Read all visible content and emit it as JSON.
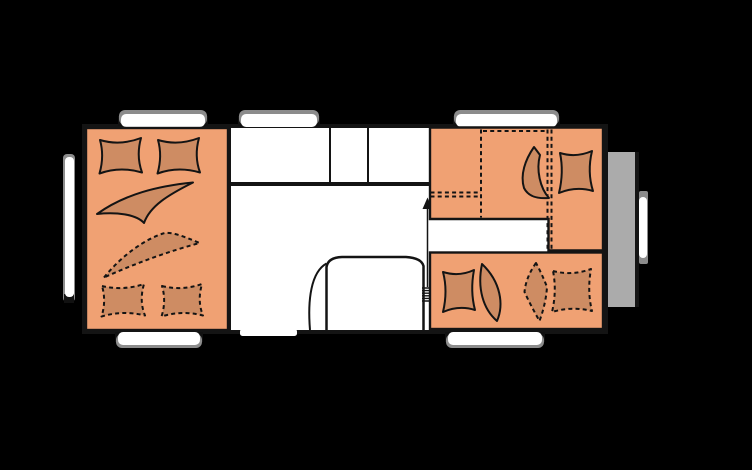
{
  "colors": {
    "background": "#000000",
    "floor": "#ffffff",
    "bed_area": "#f0a173",
    "bedding": "#ce8c63",
    "outline": "#141414",
    "front_storage": "#ababab",
    "window_frame": "#8c8c8c",
    "window_cap": "#111111"
  },
  "areas": {
    "left": "double-bed",
    "center_top": "kitchen-counter",
    "center_bottom": "washroom",
    "right_top": "dinette-bed",
    "right_bottom": "bunk-bed",
    "far_right": "front-storage"
  },
  "icons": {
    "entry_arrow": "arrow-up",
    "folding_door": "concertina-hinge",
    "door_swing": "quarter-arc"
  },
  "windows": {
    "top_count": 3,
    "bottom_count": 2,
    "left_side_count": 1,
    "front_count": 1
  }
}
